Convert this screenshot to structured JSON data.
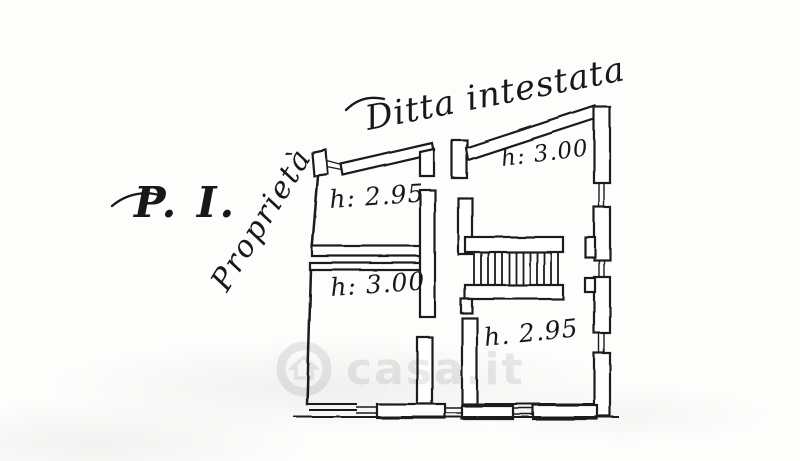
{
  "document": {
    "kind": "hand-drawn floor plan scan",
    "floor_label": "P. I.",
    "left_side_label": "Proprietà",
    "top_label": "Ditta intestata",
    "rooms": [
      {
        "name": "upper-left-room",
        "height_label": "h: 2.95"
      },
      {
        "name": "upper-right-room",
        "height_label": "h: 3.00"
      },
      {
        "name": "lower-left-room",
        "height_label": "h: 3.00"
      },
      {
        "name": "lower-right-room",
        "height_label": "h. 2.95"
      }
    ],
    "staircase": {
      "treads": 13
    }
  },
  "watermark": {
    "text": "casa.it",
    "icon": "house-in-circle-icon",
    "color": "rgba(17,17,17,0.09)"
  },
  "colors": {
    "ink": "#1a1a1a",
    "paper": "#fdfdfc"
  }
}
